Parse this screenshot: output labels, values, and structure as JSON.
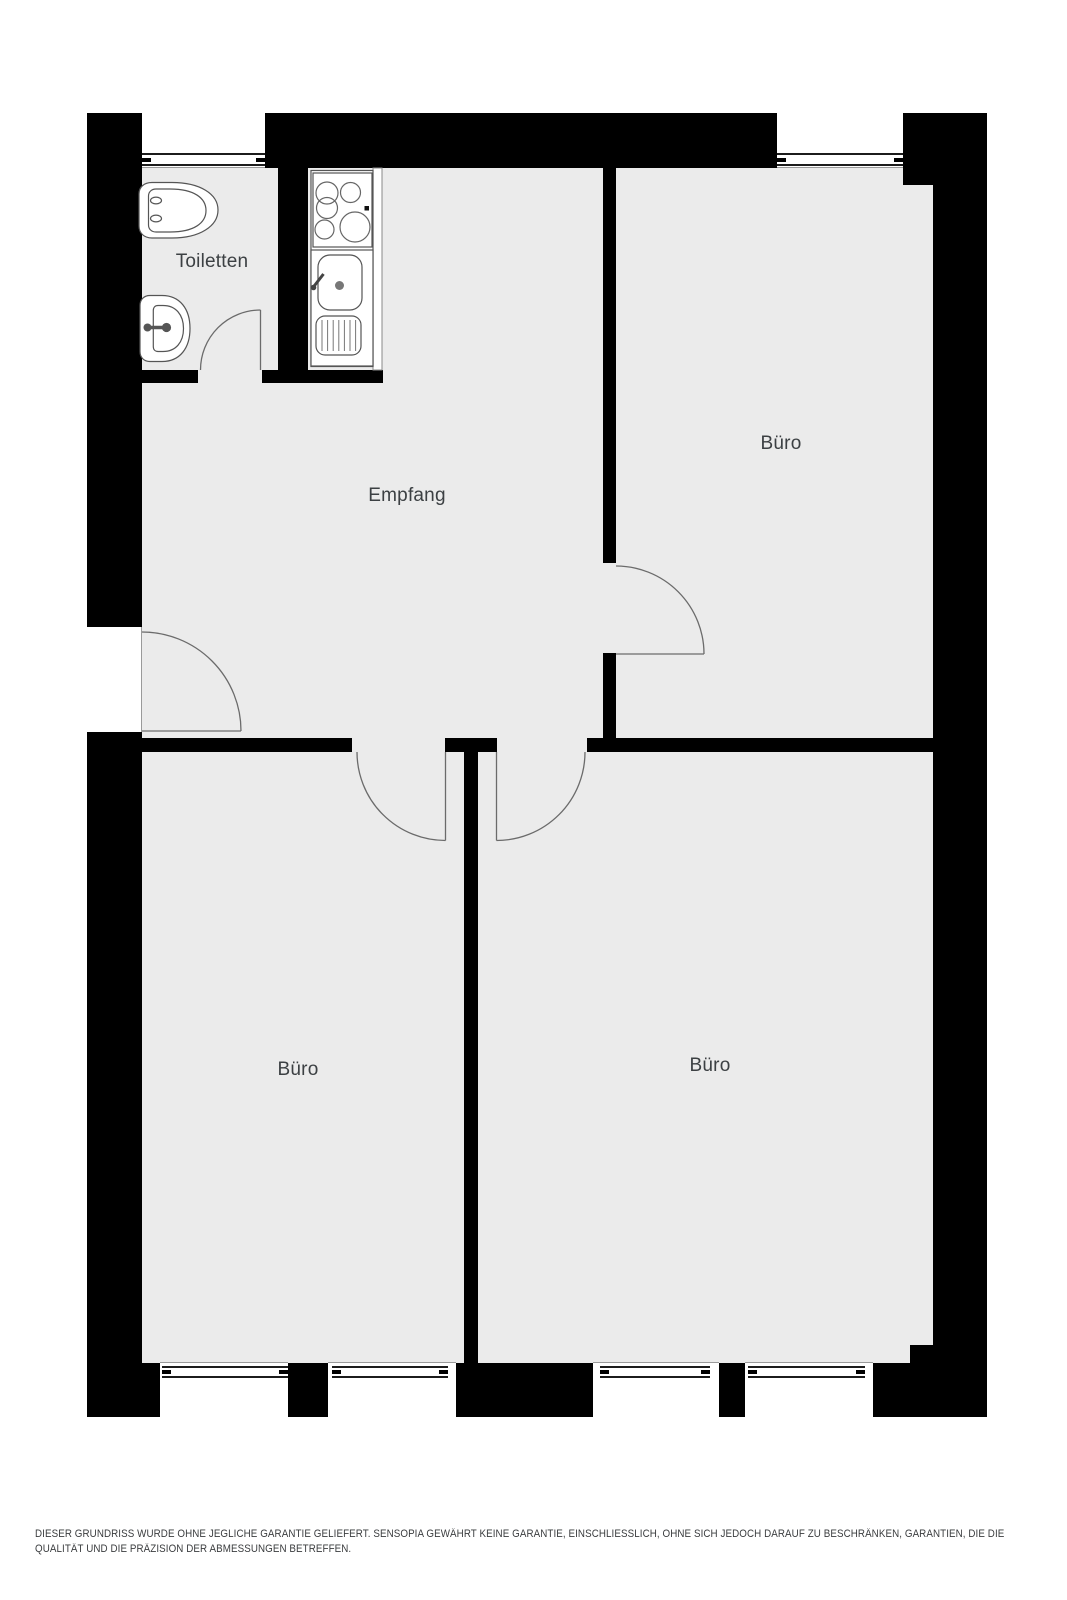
{
  "plan": {
    "floor_color": "#ebebeb",
    "wall_color": "#000000",
    "line_color": "#6b6b6b",
    "rooms": [
      {
        "id": "toiletten",
        "label": "Toiletten"
      },
      {
        "id": "empfang",
        "label": "Empfang"
      },
      {
        "id": "buero-top",
        "label": "Büro"
      },
      {
        "id": "buero-left",
        "label": "Büro"
      },
      {
        "id": "buero-right",
        "label": "Büro"
      }
    ],
    "fixtures": [
      "toilet-icon",
      "washbasin-icon",
      "stove-icon",
      "kitchen-sink-icon"
    ],
    "windows_count": 6,
    "doors_count": 5
  },
  "footer": {
    "line1": "DIESER GRUNDRISS WURDE OHNE JEGLICHE GARANTIE GELIEFERT. SENSOPIA GEWÄHRT KEINE GARANTIE, EINSCHLIESSLICH, OHNE SICH JEDOCH DARAUF ZU BESCHRÄNKEN, GARANTIEN, DIE DIE",
    "line2": "QUALITÄT UND DIE PRÄZISION DER ABMESSUNGEN BETREFFEN."
  }
}
